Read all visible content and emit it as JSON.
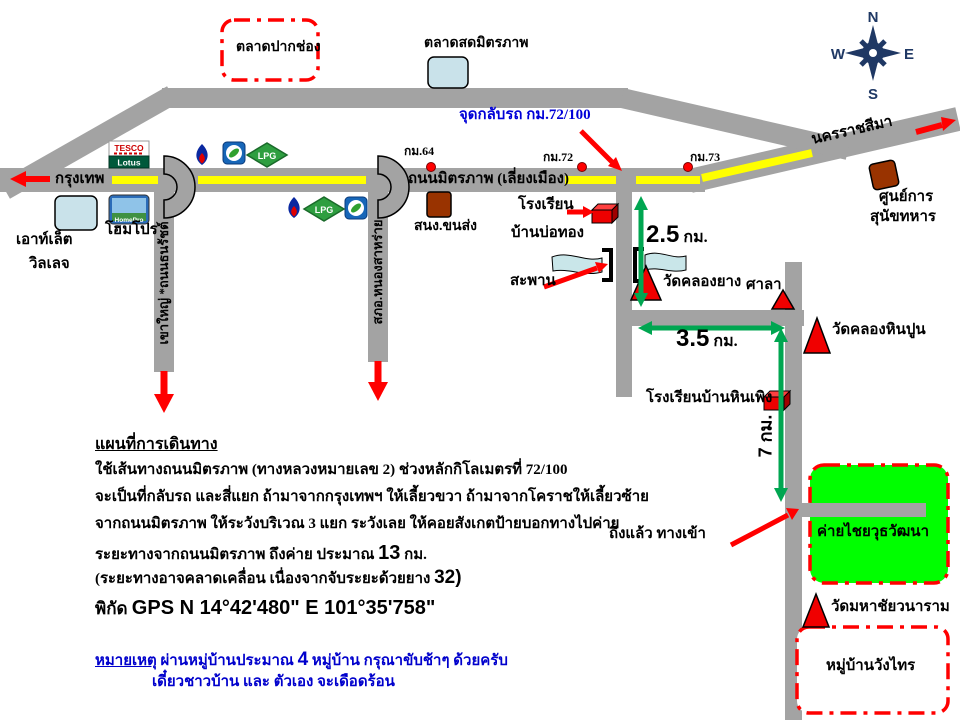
{
  "colors": {
    "road": "#a3a3a3",
    "center_line": "#ffff00",
    "river": "#c9e6e9",
    "distance_arrow": "#00a651",
    "direction_red": "#ff0000",
    "camp_green": "#00ff00",
    "note_blue": "#0000cc",
    "uturn_blue": "#0000d8",
    "compass_navy": "#1f3864",
    "building_brown": "#993300",
    "building_lightblue": "#c9e2ea"
  },
  "map": {
    "compass": {
      "n": "N",
      "e": "E",
      "s": "S",
      "w": "W"
    },
    "logos": {
      "tesco": "TESCO",
      "lotus": "Lotus",
      "lpg": "LPG",
      "homepro": "HomePro"
    },
    "labels": {
      "market_pakchong": "ตลาดปากช่อง",
      "market_mitraphap": "ตลาดสดมิตรภาพ",
      "uturn_point": "จุดกลับรถ กม.72/100",
      "km64": "กม.64",
      "km72": "กม.72",
      "km73": "กม.73",
      "highway": "ถนนมิตรภาพ (เลี่ยงเมือง)",
      "bangkok": "กรุงเทพ",
      "nakhon_ratchasima": "นครราชสีมา",
      "outlet_1": "เอาท์เล็ต",
      "outlet_2": "วิลเลจ",
      "homepro": "โฮมโปร",
      "transport_office": "สนง.ขนส่ง",
      "thanarat_road": "เขาใหญ่  *ถนนธนรัชต์",
      "nong_sarai_police": "สภอ.หนองสาหร่าย",
      "school_bothong_1": "โรงเรียน",
      "school_bothong_2": "บ้านบ่อทอง",
      "bridge": "สะพาน",
      "wat_khlong_yang": "วัดคลองยาง",
      "sala": "ศาลา",
      "wat_khlong_hinpun": "วัดคลองหินปูน",
      "school_hinphoeng": "โรงเรียนบ้านหินเพิง",
      "arrived_entrance": "ถึงแล้ว ทางเข้า",
      "camp": "ค่ายไชยวุธวัฒนา",
      "wat_mahachai": "วัดมหาชัยวนาราม",
      "village_wangsai": "หมู่บ้านวังไทร",
      "dog_center_1": "ศูนย์การ",
      "dog_center_2": "สุนัขทหาร"
    },
    "distances": {
      "d25": "2.5",
      "d25_unit": "กม.",
      "d35": "3.5",
      "d35_unit": "กม.",
      "d7": "7 กม."
    }
  },
  "notes": {
    "heading": "แผนที่การเดินทาง",
    "line1": "ใช้เส้นทางถนนมิตรภาพ (ทางหลวงหมายเลข 2) ช่วงหลักกิโลเมตรที่ 72/100",
    "line2": "จะเป็นที่กลับรถ และสี่แยก ถ้ามาจากกรุงเทพฯ ให้เลี้ยวขวา ถ้ามาจากโคราชให้เลี้ยวซ้าย",
    "line3": "จากถนนมิตรภาพ ให้ระวังบริเวณ 3 แยก ระวังเลย ให้คอยสังเกตป้ายบอกทางไปค่าย",
    "line4_a": "ระยะทางจากถนนมิตรภาพ ถึงค่าย ประมาณ ",
    "line4_num": "13",
    "line4_b": " กม.",
    "line5_a": "(ระยะทางอาจคลาดเคลื่อน เนื่องจากจับระยะด้วยยาง ",
    "line5_num": "32)",
    "gps_label": "พิกัด ",
    "gps_value": "GPS   N 14°42'480\"   E 101°35'758\"",
    "note_label": "หมายเหตุ",
    "note1_a": " ผ่านหมู่บ้านประมาณ ",
    "note1_num": "4",
    "note1_b": " หมู่บ้าน กรุณาขับช้าๆ ด้วยครับ",
    "note2": "เดี๋ยวชาวบ้าน และ ตัวเอง จะเดือดร้อน"
  }
}
